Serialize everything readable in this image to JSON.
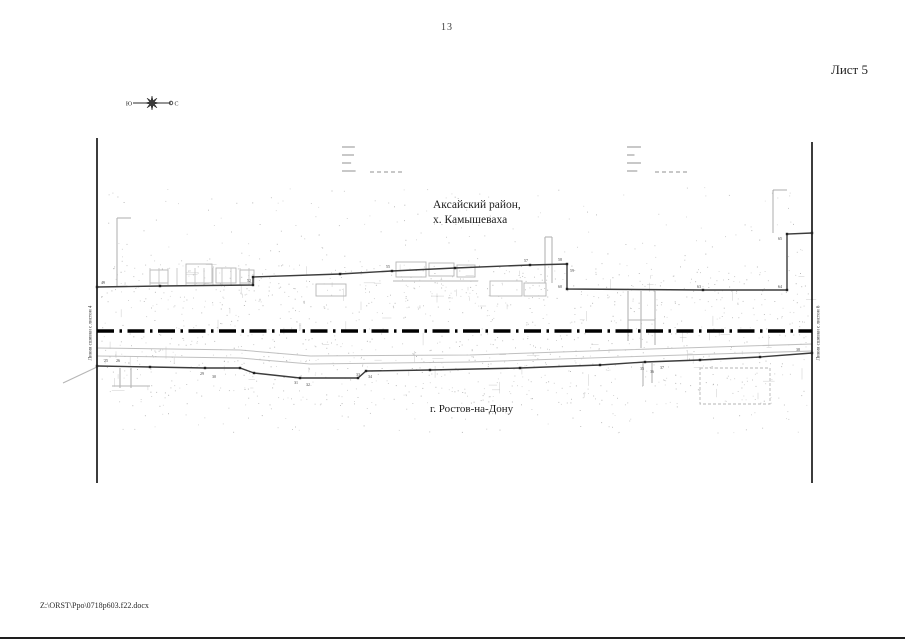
{
  "page": {
    "number": "13",
    "sheet_label": "Лист 5",
    "footer_path": "Z:\\ORST\\Ppo\\0718p603.f22.docx"
  },
  "compass": {
    "left_letter": "Ю",
    "right_letter": "С"
  },
  "map": {
    "labels": {
      "district_line1": "Аксайский район,",
      "district_line2": "х. Камышеваха",
      "city": "г. Ростов-на-Дону",
      "left_match_line": "Линия сшивки с листом 4",
      "right_match_line": "Линия сшивки с листом 6"
    },
    "colors": {
      "frame": "#1a1a1a",
      "admin_boundary": "#000000",
      "parcel_boundary": "#3c3c3c",
      "detail_gray": "#b5b5b5",
      "speckle": "#8a8a8a"
    },
    "geometry": {
      "frame_left": {
        "x": 97,
        "y1": 138,
        "y2": 483
      },
      "frame_right": {
        "x": 812,
        "y1": 142,
        "y2": 483
      },
      "admin_boundary": {
        "y": 331,
        "x1": 97,
        "x2": 812
      },
      "upper_boundary": [
        [
          97,
          287
        ],
        [
          160,
          286
        ],
        [
          253,
          285
        ],
        [
          253,
          277
        ],
        [
          340,
          274
        ],
        [
          392,
          271
        ],
        [
          455,
          268
        ],
        [
          530,
          265
        ],
        [
          567,
          264
        ],
        [
          567,
          289
        ],
        [
          703,
          290
        ],
        [
          787,
          290
        ],
        [
          787,
          234
        ],
        [
          812,
          233
        ]
      ],
      "lower_boundary": [
        [
          97,
          366
        ],
        [
          150,
          367
        ],
        [
          205,
          368
        ],
        [
          240,
          368
        ],
        [
          254,
          373
        ],
        [
          300,
          378
        ],
        [
          358,
          378
        ],
        [
          366,
          371
        ],
        [
          430,
          370
        ],
        [
          520,
          368
        ],
        [
          600,
          365
        ],
        [
          645,
          362
        ],
        [
          700,
          360
        ],
        [
          760,
          357
        ],
        [
          812,
          353
        ]
      ],
      "point_labels": [
        {
          "x": 101,
          "y": 284,
          "t": "49"
        },
        {
          "x": 247,
          "y": 282,
          "t": "52"
        },
        {
          "x": 386,
          "y": 268,
          "t": "55"
        },
        {
          "x": 524,
          "y": 262,
          "t": "57"
        },
        {
          "x": 558,
          "y": 261,
          "t": "58"
        },
        {
          "x": 570,
          "y": 272,
          "t": "59"
        },
        {
          "x": 558,
          "y": 288,
          "t": "60"
        },
        {
          "x": 697,
          "y": 288,
          "t": "63"
        },
        {
          "x": 778,
          "y": 288,
          "t": "64"
        },
        {
          "x": 778,
          "y": 240,
          "t": "65"
        },
        {
          "x": 104,
          "y": 362,
          "t": "25"
        },
        {
          "x": 116,
          "y": 362,
          "t": "26"
        },
        {
          "x": 200,
          "y": 375,
          "t": "29"
        },
        {
          "x": 212,
          "y": 378,
          "t": "30"
        },
        {
          "x": 294,
          "y": 384,
          "t": "31"
        },
        {
          "x": 306,
          "y": 386,
          "t": "32"
        },
        {
          "x": 356,
          "y": 376,
          "t": "33"
        },
        {
          "x": 368,
          "y": 378,
          "t": "34"
        },
        {
          "x": 640,
          "y": 370,
          "t": "35"
        },
        {
          "x": 650,
          "y": 373,
          "t": "36"
        },
        {
          "x": 660,
          "y": 369,
          "t": "37"
        },
        {
          "x": 796,
          "y": 351,
          "t": "38"
        }
      ],
      "gray_lines": [
        [
          117,
          218,
          117,
          286
        ],
        [
          117,
          218,
          131,
          218
        ],
        [
          545,
          237,
          545,
          283
        ],
        [
          552,
          237,
          552,
          283
        ],
        [
          545,
          237,
          552,
          237
        ],
        [
          628,
          291,
          628,
          341
        ],
        [
          641,
          291,
          641,
          348
        ],
        [
          655,
          291,
          655,
          345
        ],
        [
          628,
          320,
          655,
          320
        ],
        [
          773,
          190,
          773,
          233
        ],
        [
          773,
          190,
          787,
          190
        ],
        [
          393,
          281,
          478,
          281
        ],
        [
          63,
          383,
          97,
          367
        ],
        [
          120,
          368,
          120,
          388
        ],
        [
          131,
          368,
          131,
          388
        ],
        [
          112,
          386,
          150,
          386
        ],
        [
          643,
          363,
          643,
          386
        ],
        [
          652,
          363,
          652,
          383
        ]
      ],
      "gray_rects": [
        [
          150,
          270,
          18,
          13
        ],
        [
          186,
          264,
          26,
          19
        ],
        [
          216,
          268,
          20,
          15
        ],
        [
          240,
          270,
          14,
          13
        ],
        [
          316,
          284,
          30,
          12
        ],
        [
          396,
          262,
          30,
          15
        ],
        [
          429,
          263,
          25,
          13
        ],
        [
          457,
          265,
          18,
          12
        ],
        [
          490,
          281,
          32,
          15
        ],
        [
          524,
          283,
          22,
          13
        ]
      ],
      "dashed_rects": [
        [
          700,
          368,
          70,
          36
        ]
      ],
      "road_lines": [
        [
          [
            97,
            348
          ],
          [
            240,
            350
          ],
          [
            310,
            356
          ],
          [
            470,
            355
          ],
          [
            620,
            350
          ],
          [
            812,
            344
          ]
        ],
        [
          [
            97,
            356
          ],
          [
            240,
            358
          ],
          [
            310,
            364
          ],
          [
            470,
            362
          ],
          [
            620,
            357
          ],
          [
            812,
            351
          ]
        ]
      ],
      "tiny_clusters": [
        [
          342,
          146
        ],
        [
          627,
          146
        ]
      ],
      "fence": {
        "x0": 150,
        "step": 9,
        "n": 12,
        "y1": 268,
        "y2": 285
      }
    }
  }
}
